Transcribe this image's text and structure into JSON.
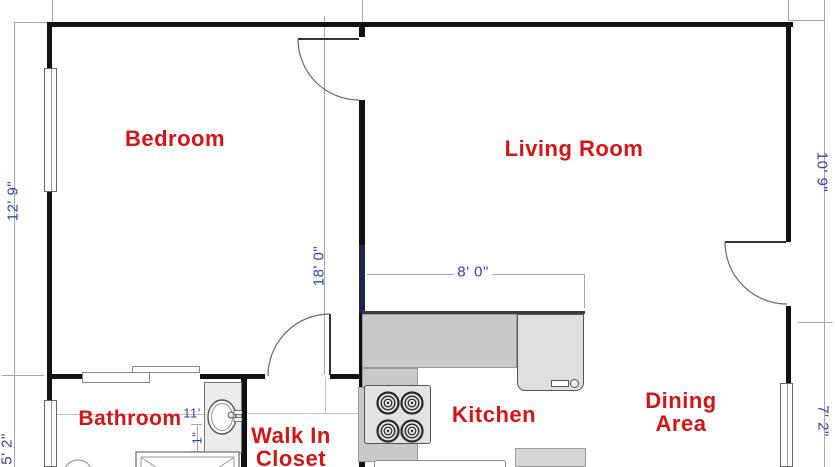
{
  "rooms": {
    "bedroom": {
      "label": "Bedroom"
    },
    "living": {
      "label": "Living Room"
    },
    "bathroom": {
      "label": "Bathroom"
    },
    "closet": {
      "line1": "Walk In",
      "line2": "Closet"
    },
    "kitchen": {
      "label": "Kitchen"
    },
    "dining": {
      "line1": "Dining",
      "line2": "Area"
    }
  },
  "dimensions": {
    "left_upper": "12' 9\"",
    "left_lower": "5' 2\"",
    "center_vertical": "18' 0\"",
    "kitchen_width": "8' 0\"",
    "right_upper": "10' 9\"",
    "right_lower": "7' 2\"",
    "bathroom_width": "11'",
    "bathroom_offset": "1\""
  },
  "colors": {
    "room-label": "#d01616",
    "dimension": "#3b3bb0",
    "wall": "#111111",
    "counter": "#c9c9c9",
    "appliance": "#e2e2e2"
  }
}
